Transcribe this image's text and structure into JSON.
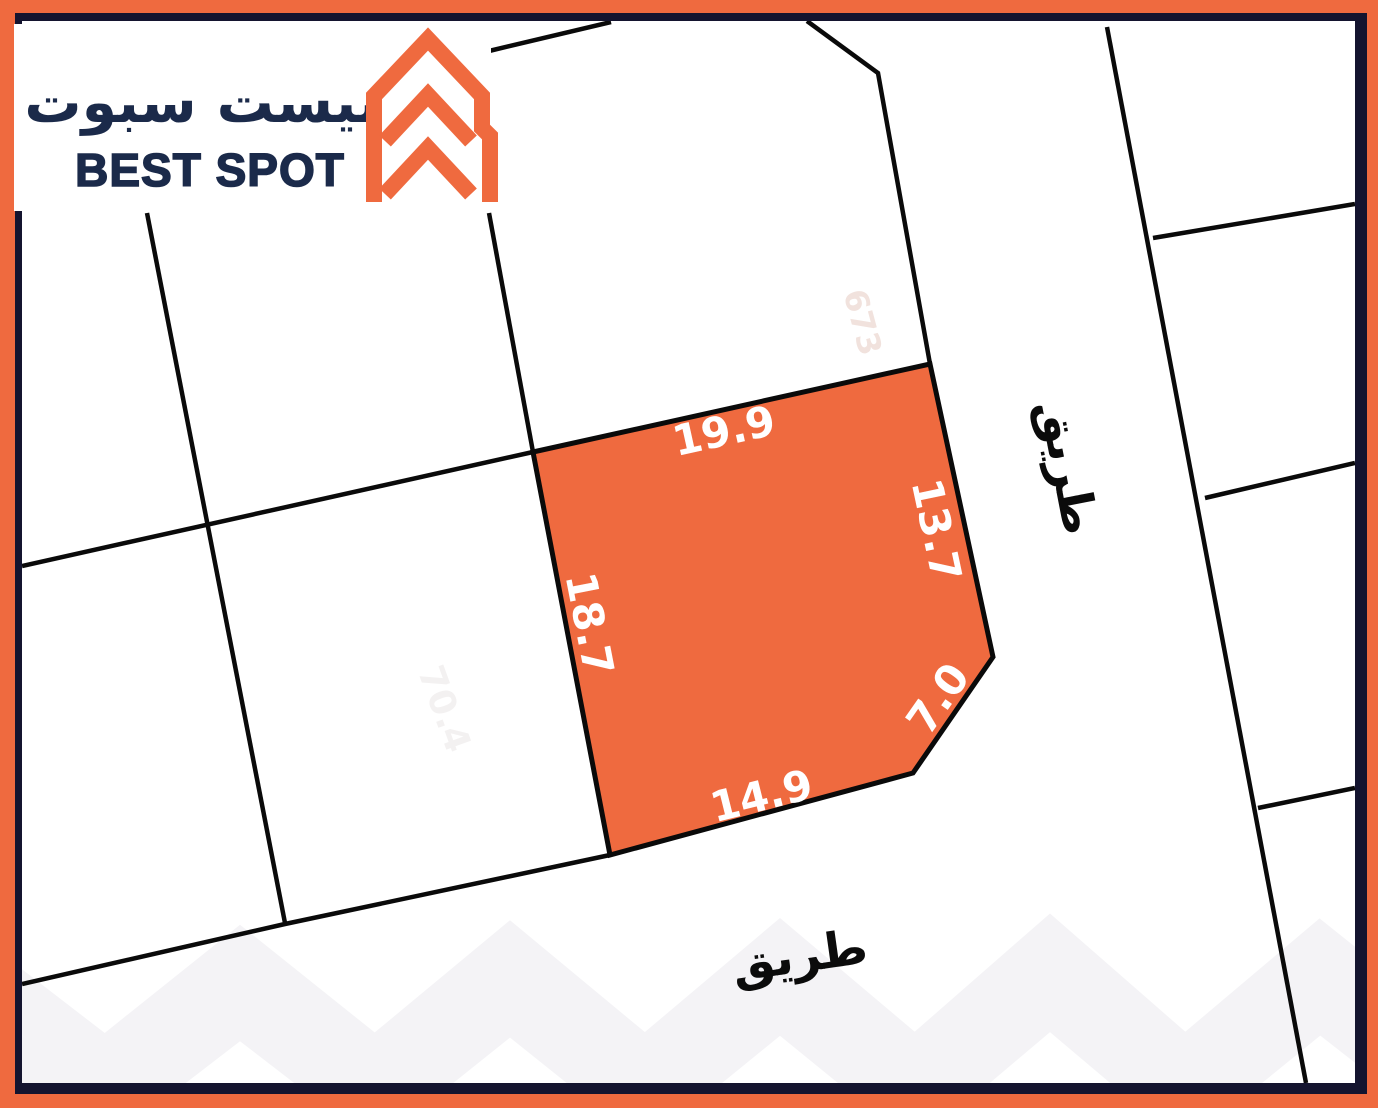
{
  "logo": {
    "arabic": "بيست سبوت",
    "english": "BEST SPOT"
  },
  "plot": {
    "fill_color": "#EF6A3F",
    "dimensions": {
      "top": "19.9",
      "right": "13.7",
      "corner": "7.0",
      "bottom": "14.9",
      "left": "18.7"
    }
  },
  "roads": {
    "right_label": "طريق",
    "bottom_label": "طريق"
  },
  "faint": {
    "plot_number": "673",
    "neighbor_number": "70.4"
  },
  "colors": {
    "border_orange": "#EF6A3F",
    "border_navy": "#14142F",
    "map_line": "#0a0a0a",
    "logo_navy": "#1B2A4A",
    "watermark": "#f4f3f6"
  }
}
